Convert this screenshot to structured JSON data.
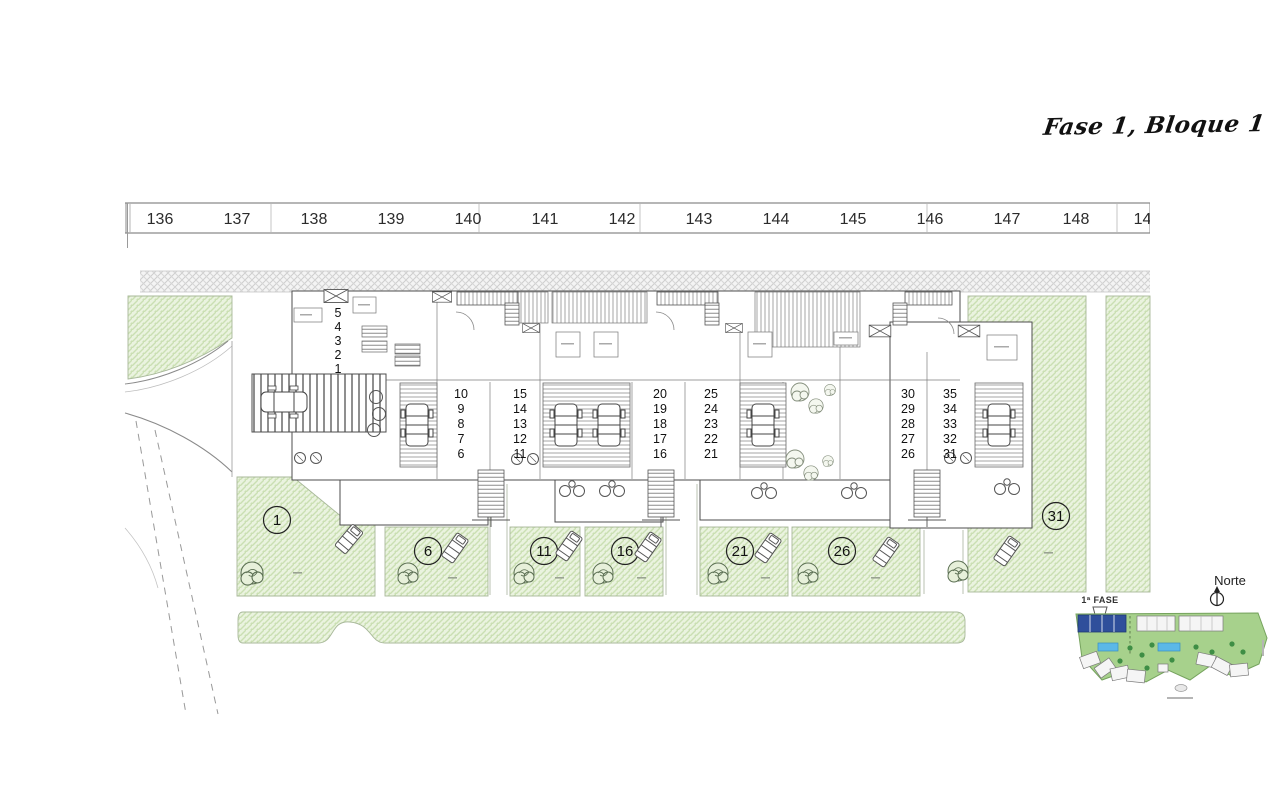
{
  "document": {
    "title": "Fase 1, Bloque 1"
  },
  "street_numbers": [
    "136",
    "137",
    "138",
    "139",
    "140",
    "141",
    "142",
    "143",
    "144",
    "145",
    "146",
    "147",
    "148",
    "149"
  ],
  "unit_columns": [
    {
      "values": [
        "5",
        "4",
        "3",
        "2",
        "1"
      ]
    },
    {
      "values": [
        "10",
        "9",
        "8",
        "7",
        "6"
      ]
    },
    {
      "values": [
        "15",
        "14",
        "13",
        "12",
        "11"
      ]
    },
    {
      "values": [
        "20",
        "19",
        "18",
        "17",
        "16"
      ]
    },
    {
      "values": [
        "25",
        "24",
        "23",
        "22",
        "21"
      ]
    },
    {
      "values": [
        "30",
        "29",
        "28",
        "27",
        "26"
      ]
    },
    {
      "values": [
        "35",
        "34",
        "33",
        "32",
        "31"
      ]
    }
  ],
  "garden_plots": [
    "1",
    "6",
    "11",
    "16",
    "21",
    "26",
    "31"
  ],
  "compass": {
    "label": "Norte"
  },
  "minimap": {
    "phase_label": "1ª FASE"
  },
  "colors": {
    "garden_fill": "#eaf3df",
    "garden_hatch": "#cadfb2",
    "map_green": "#a7d18c",
    "phase_blue": "#2f4f9b",
    "pool_blue": "#5bb8e8",
    "line": "#4d4d4d",
    "ink": "#1a1a1a"
  }
}
